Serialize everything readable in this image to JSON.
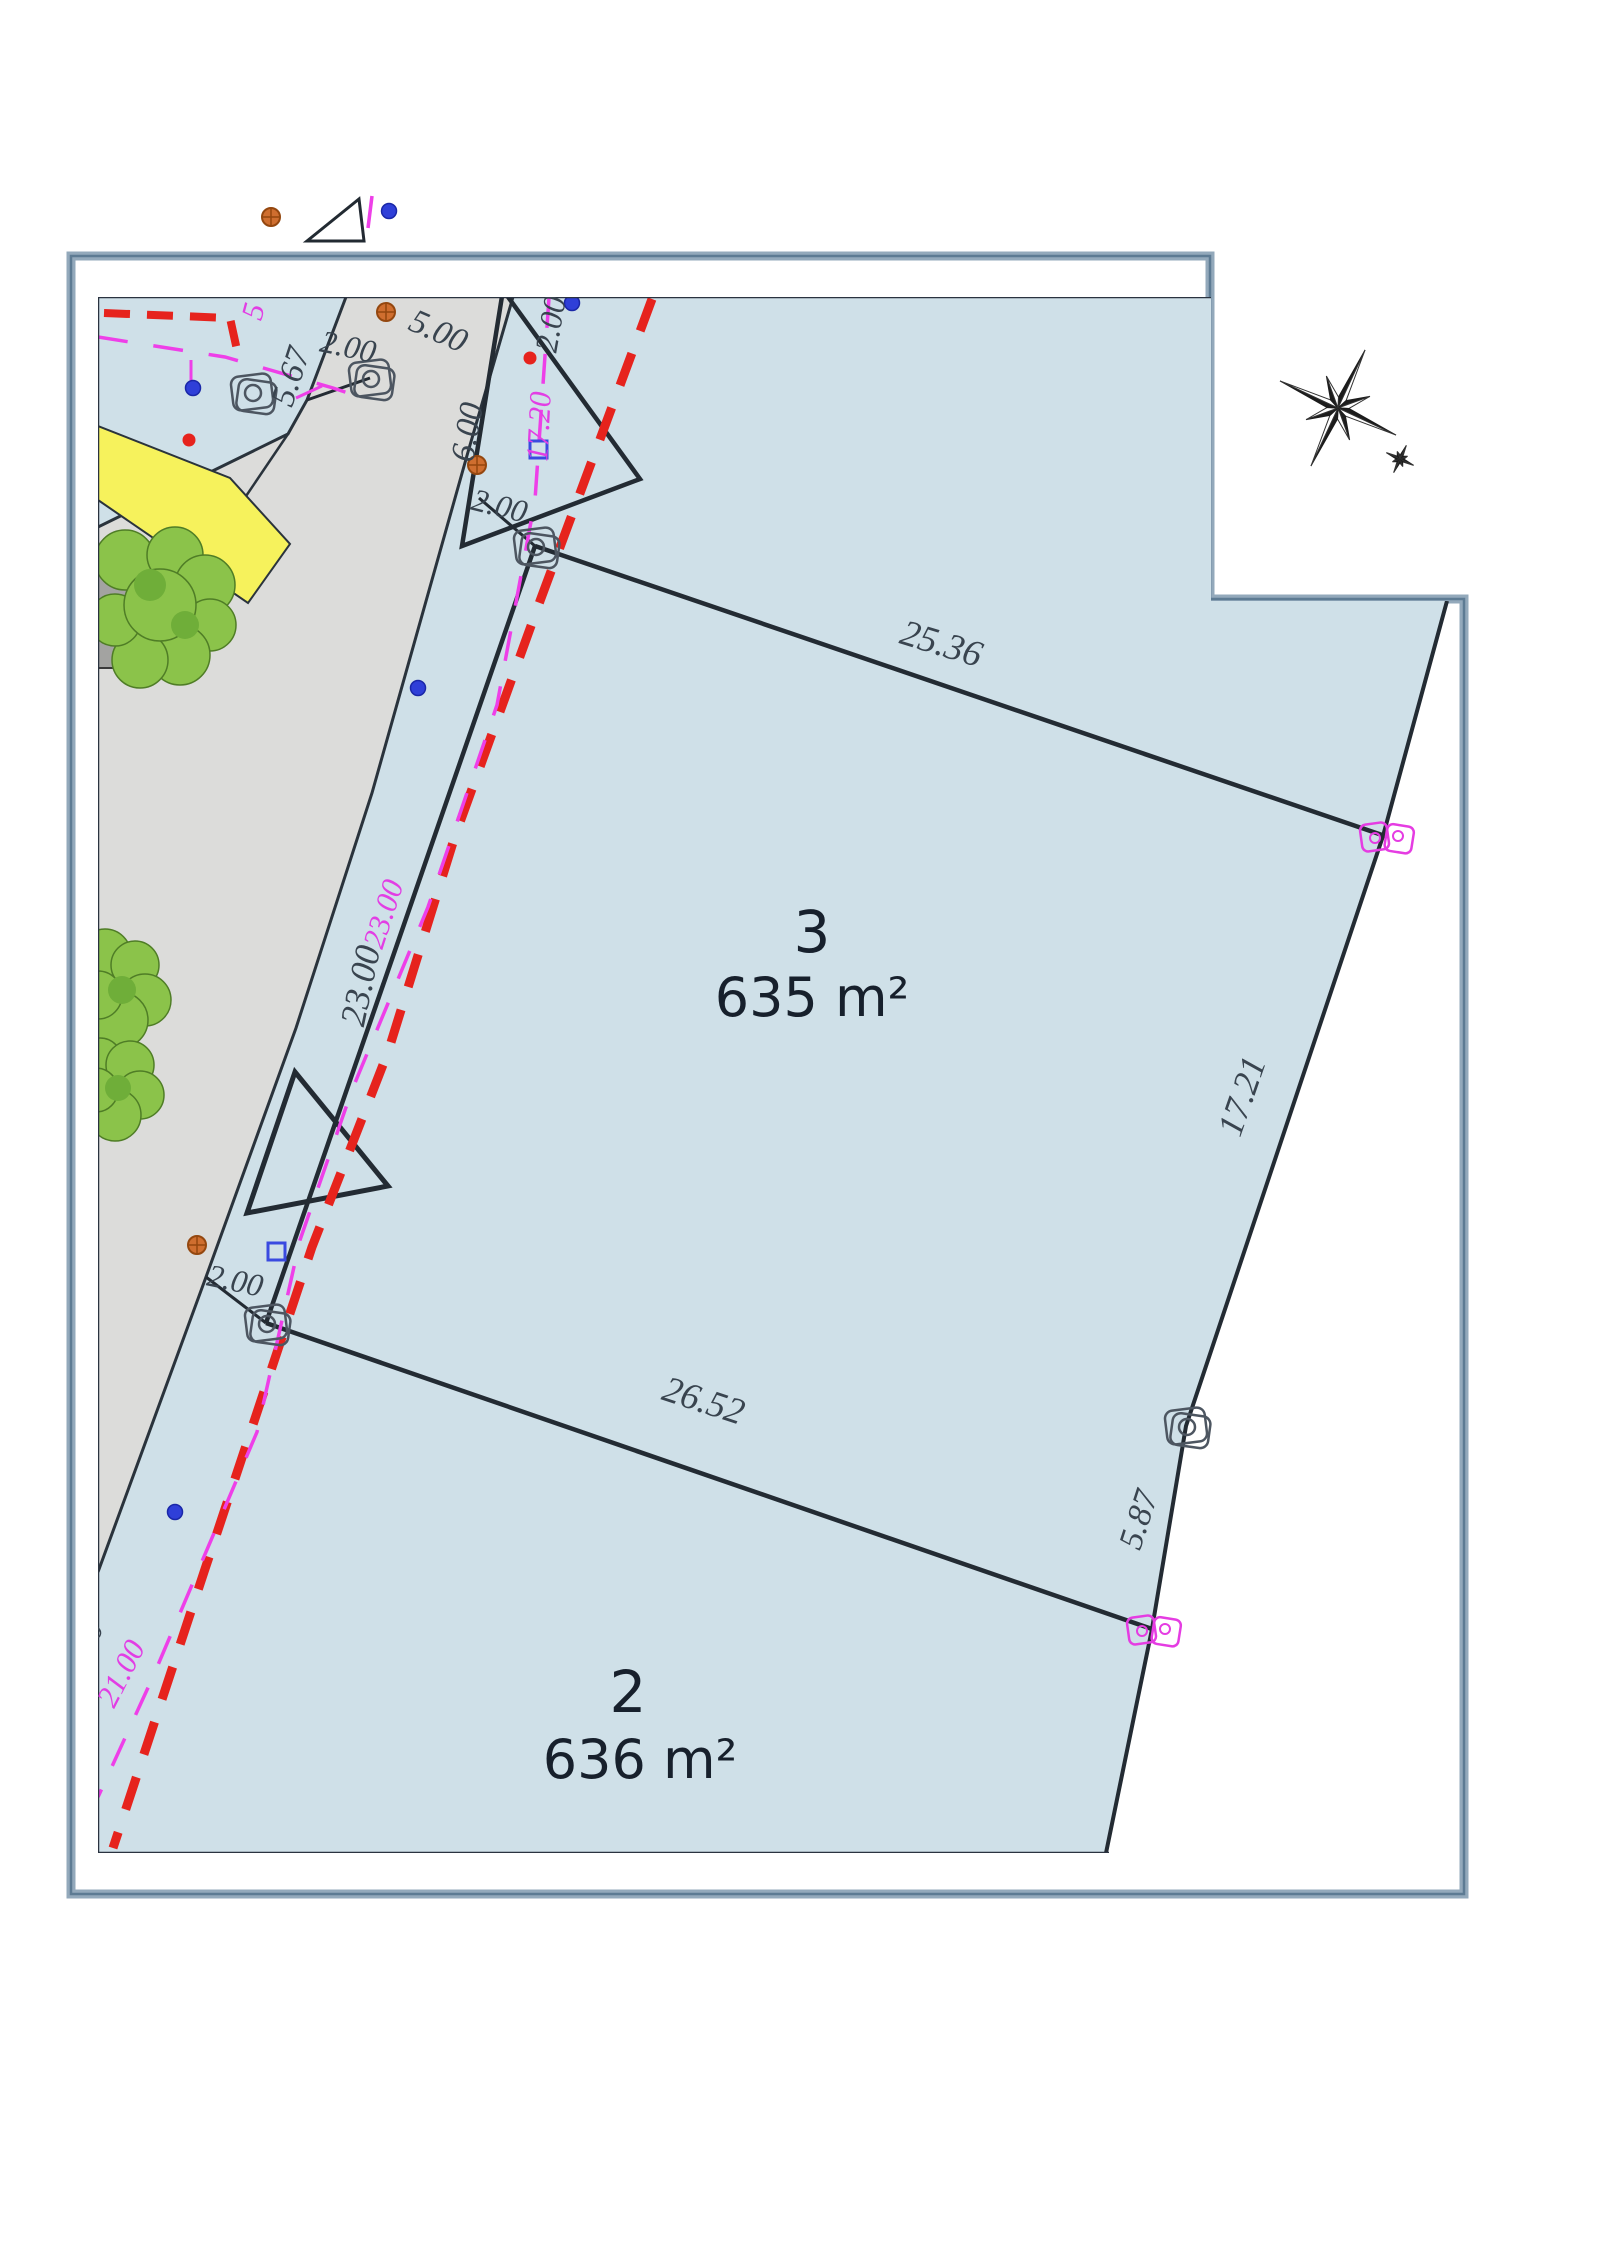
{
  "plan": {
    "kind_label": "land division plan",
    "colors": {
      "parcel_fill": "#cfe0e8",
      "road_fill": "#dcdcda",
      "highlight_yellow": "#f6f25c",
      "boundary_red": "#e6231d",
      "utility_magenta": "#ee3fe8",
      "tree_green": "#8bc34a",
      "frame_blue": "#8099ad",
      "ink": "#2a3340"
    }
  },
  "parcels": {
    "parcel3": {
      "number": "3",
      "area": "635 m²"
    },
    "parcel2": {
      "number": "2",
      "area": "636 m²"
    }
  },
  "dimensions": {
    "top": "25.36",
    "right": "17.21",
    "middle": "26.52",
    "right_lower": "5.87",
    "left": "23.00",
    "left_upper": "5.67",
    "road_width": "5.00",
    "road_side": "6.00",
    "offset_top": "2.00",
    "offset_upper": "2.00",
    "offset_corner3": "2.00",
    "offset_corner2": "2.00",
    "partial_left": "00"
  },
  "utility_labels": {
    "upper": "17.20",
    "middle": "23.00",
    "lower": "21.00",
    "top_partial": "5"
  }
}
